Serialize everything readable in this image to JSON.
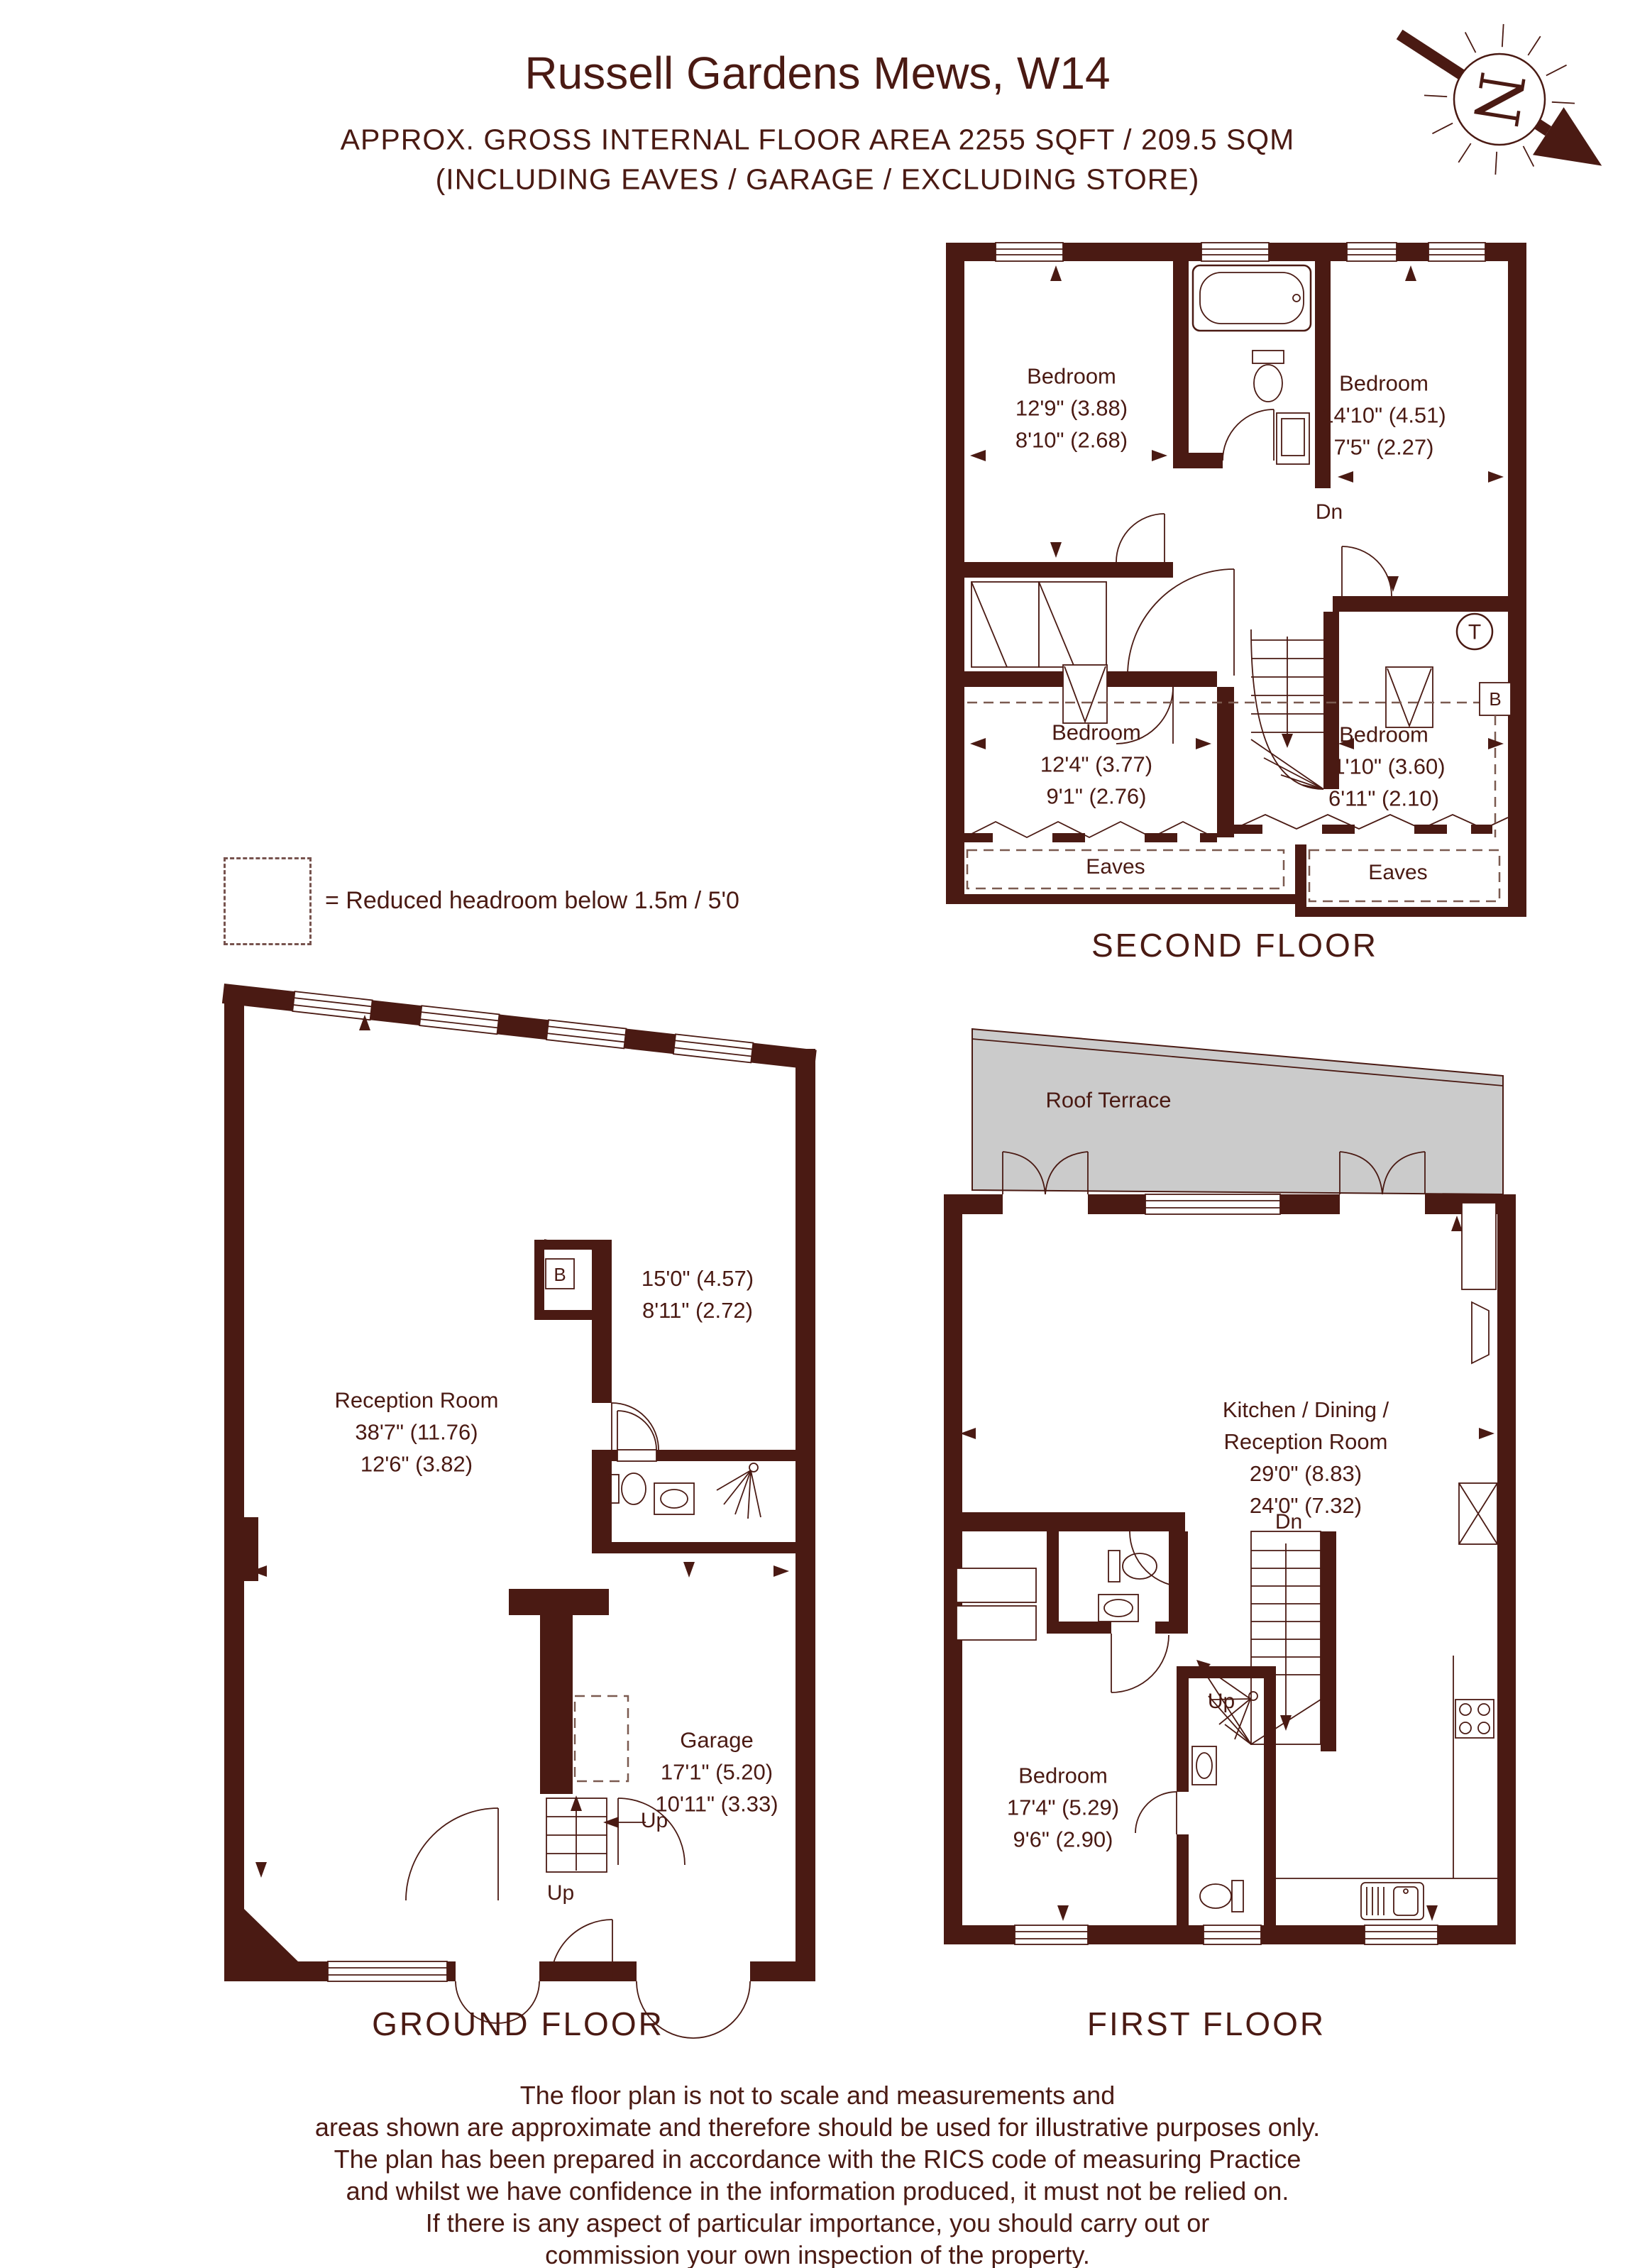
{
  "colors": {
    "ink": "#4A1A13",
    "terrace_fill": "#CBCBCB"
  },
  "header": {
    "title": "Russell Gardens Mews, W14",
    "subtitle_line1": "APPROX. GROSS INTERNAL FLOOR AREA 2255 SQFT / 209.5 SQM",
    "subtitle_line2": "(INCLUDING EAVES / GARAGE / EXCLUDING STORE)",
    "compass_letter": "N"
  },
  "legend": {
    "text": "= Reduced headroom below 1.5m / 5'0"
  },
  "floors": {
    "second": {
      "name": "SECOND FLOOR",
      "rooms": [
        {
          "label": "Bedroom",
          "dim1": "12'9\" (3.88)",
          "dim2": "8'10\" (2.68)"
        },
        {
          "label": "Bedroom",
          "dim1": "14'10\" (4.51)",
          "dim2": "7'5\" (2.27)"
        },
        {
          "label": "Bedroom",
          "dim1": "12'4\" (3.77)",
          "dim2": "9'1\" (2.76)"
        },
        {
          "label": "Bedroom",
          "dim1": "11'10\" (3.60)",
          "dim2": "6'11\" (2.10)"
        }
      ],
      "eaves_left": "Eaves",
      "eaves_right": "Eaves",
      "stair_down": "Dn",
      "thermostat": "T",
      "boiler": "B"
    },
    "ground": {
      "name": "GROUND FLOOR",
      "reception": {
        "label": "Reception Room",
        "dim1": "38'7\" (11.76)",
        "dim2": "12'6\" (3.82)"
      },
      "back_room": {
        "dim1": "15'0\" (4.57)",
        "dim2": "8'11\" (2.72)"
      },
      "garage": {
        "label": "Garage",
        "dim1": "17'1\" (5.20)",
        "dim2": "10'11\" (3.33)"
      },
      "boiler": "B",
      "stair_up1": "Up",
      "stair_up2": "Up"
    },
    "first": {
      "name": "FIRST FLOOR",
      "terrace": "Roof Terrace",
      "kitchen": {
        "label_line1": "Kitchen / Dining /",
        "label_line2": "Reception Room",
        "dim1": "29'0\" (8.83)",
        "dim2": "24'0\" (7.32)"
      },
      "bedroom": {
        "label": "Bedroom",
        "dim1": "17'4\" (5.29)",
        "dim2": "9'6\" (2.90)"
      },
      "stair_down": "Dn",
      "stair_up": "Up"
    }
  },
  "footer": {
    "lines": [
      "The floor plan is not to scale and measurements and",
      "areas shown are approximate and therefore should be used for illustrative purposes only.",
      "The plan has been prepared in accordance with the RICS code of measuring Practice",
      "and whilst we have confidence in the information produced, it must not be relied on.",
      "If there is any aspect of particular importance, you should carry out or",
      "commission your own inspection of the property."
    ]
  }
}
